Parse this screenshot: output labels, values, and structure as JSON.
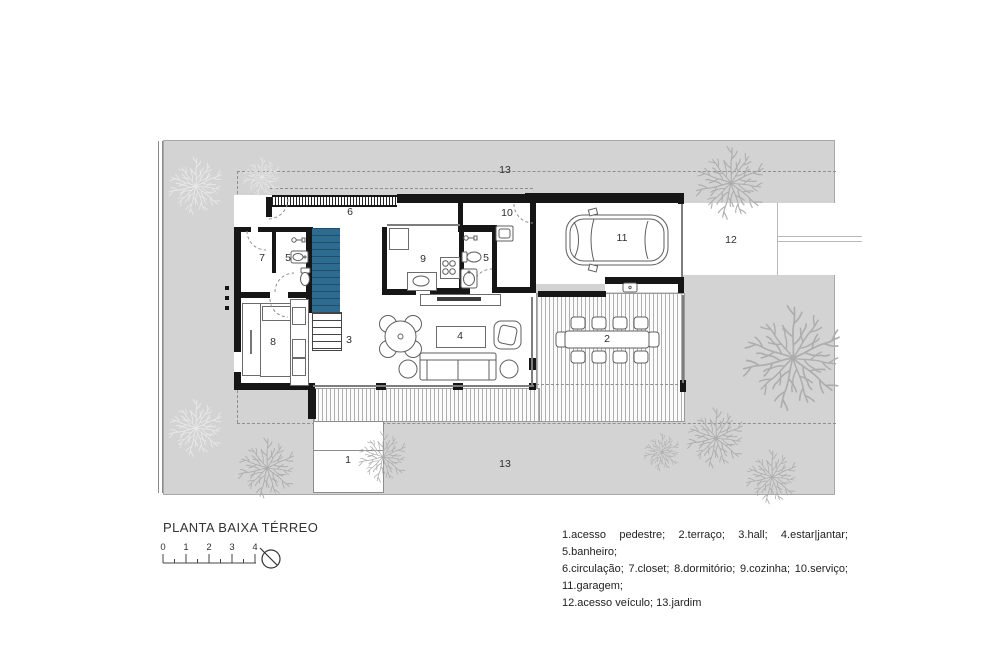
{
  "title": "PLANTA BAIXA TÉRREO",
  "legend": {
    "line1": "1.acesso pedestre; 2.terraço; 3.hall; 4.estar|jantar; 5.banheiro;",
    "line2": "6.circulação; 7.closet; 8.dormitório; 9.cozinha; 10.serviço; 11.garagem;",
    "line3": "12.acesso veículo; 13.jardim"
  },
  "scale_bar": {
    "ticks": [
      "0",
      "1",
      "2",
      "3",
      "4"
    ]
  },
  "room_labels": [
    {
      "room": "acesso-pedestre",
      "text": "1"
    },
    {
      "room": "terraco",
      "text": "2"
    },
    {
      "room": "hall",
      "text": "3"
    },
    {
      "room": "estar-jantar",
      "text": "4"
    },
    {
      "room": "banheiro-1",
      "text": "5"
    },
    {
      "room": "banheiro-2",
      "text": "5"
    },
    {
      "room": "circulacao",
      "text": "6"
    },
    {
      "room": "closet",
      "text": "7"
    },
    {
      "room": "dormitorio",
      "text": "8"
    },
    {
      "room": "cozinha",
      "text": "9"
    },
    {
      "room": "servico",
      "text": "10"
    },
    {
      "room": "garagem",
      "text": "11"
    },
    {
      "room": "acesso-veiculo",
      "text": "12"
    },
    {
      "room": "jardim-top",
      "text": "13"
    },
    {
      "room": "jardim-bottom",
      "text": "13"
    }
  ],
  "colors": {
    "lot_fill": "#d3d3d3",
    "stair_fill": "#2e6b90",
    "wall_fill": "#161616",
    "tree_light": "#e9e9e9",
    "tree_dark": "#adadad",
    "deck_line": "#b0b0b0"
  }
}
